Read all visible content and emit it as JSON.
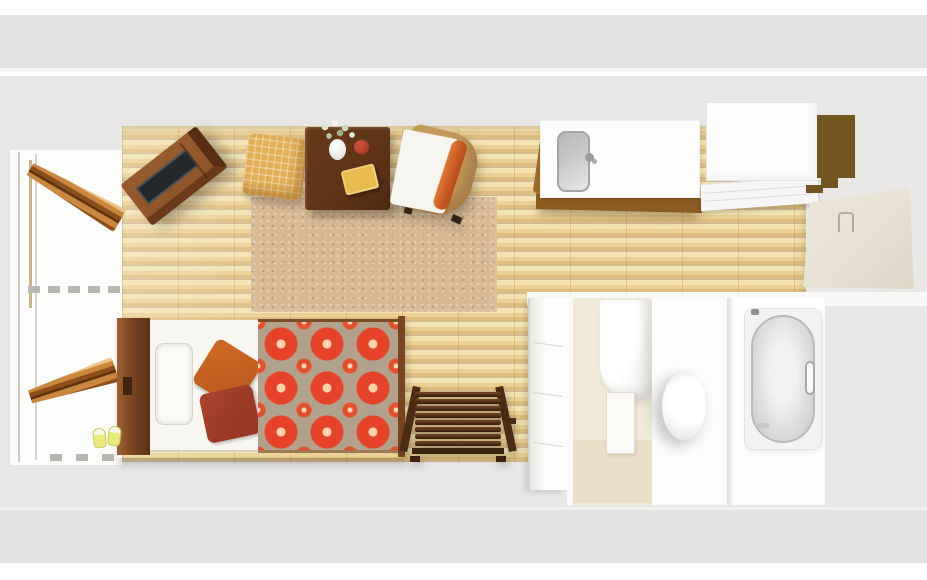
{
  "scene": {
    "view": "top-down-3d-floorplan-render",
    "objects": {
      "window_bay": "balcony-window",
      "balcony_door_upper": "open-balcony-door-upper",
      "balcony_door_lower": "open-balcony-door-lower",
      "tv_cabinet": "tv-sideboard",
      "tv_screen": "tv-screen",
      "ottoman": "rattan-ottoman",
      "table": "low-coffee-table",
      "flowers": "flower-arrangement",
      "vase": "white-vase",
      "teapot": "red-teapot",
      "table_cushion": "yellow-cushion",
      "chair": "armchair-with-orange-bolster",
      "rug": "beige-area-rug",
      "counter": "kitchen-counter",
      "sink": "kitchen-sink",
      "faucet": "sink-faucet",
      "fridge": "refrigerator-tall-cabinet",
      "panel": "kitchen-cabinet-panel",
      "entry_door": "entry-door",
      "bed": "single-bed",
      "headboard": "bed-headboard",
      "bed_pillow": "white-bed-pillow",
      "pillow_orange": "orange-throw-pillow",
      "pillow_maroon": "maroon-throw-pillow",
      "blanket": "red-floral-blanket",
      "slippers": "yellow-slippers",
      "bench": "dark-wood-slatted-bench",
      "drawer_unit": "white-drawer-cabinet",
      "laundry_room": "laundry-room",
      "washer": "washing-machine",
      "laundry_door": "laundry-door-panel",
      "toilet_room": "toilet-room",
      "toilet": "toilet",
      "bath_room": "bathroom",
      "bathtub": "bathtub",
      "floor": "light-oak-plank-floor"
    }
  },
  "colors": {
    "wall_band": "#e2e2e1",
    "interior": "#e8e7e5",
    "wood_light": "#f3e3b1",
    "wood_mid": "#ebd193",
    "wood_dark": "#ddbe7f",
    "rug": "#d6b893",
    "table": "#5e3418",
    "table_cushion": "#e9ba4d",
    "cabinet_top": "#8f5428",
    "cabinet_side": "#572d13",
    "tv_screen": "#23282a",
    "ottoman": "#e3ad55",
    "chair_frame": "#c49b5d",
    "chair_cushion": "#f7f5f0",
    "chair_pillow": "#cd5f27",
    "counter_base": "#8a5c20",
    "sink": "#c6c6c6",
    "panel_brown": "#73551f",
    "entry_door": "#e6e1d3",
    "open_door_light": "#c9873f",
    "open_door_dark": "#8d4f1a",
    "bed_frame": "#7a4423",
    "mattress": "#f9f7f2",
    "pillow_orange": "#c05c1e",
    "pillow_maroon": "#9a3926",
    "blanket_bg": "#b2a18c",
    "blanket_flower": "#e7432a",
    "blanket_center": "#ffd2a8",
    "bench": "#53301a",
    "slippers": "#e9e97e",
    "cream_room": "#f1e9d7",
    "tub_rim": "#c9c9c8"
  }
}
